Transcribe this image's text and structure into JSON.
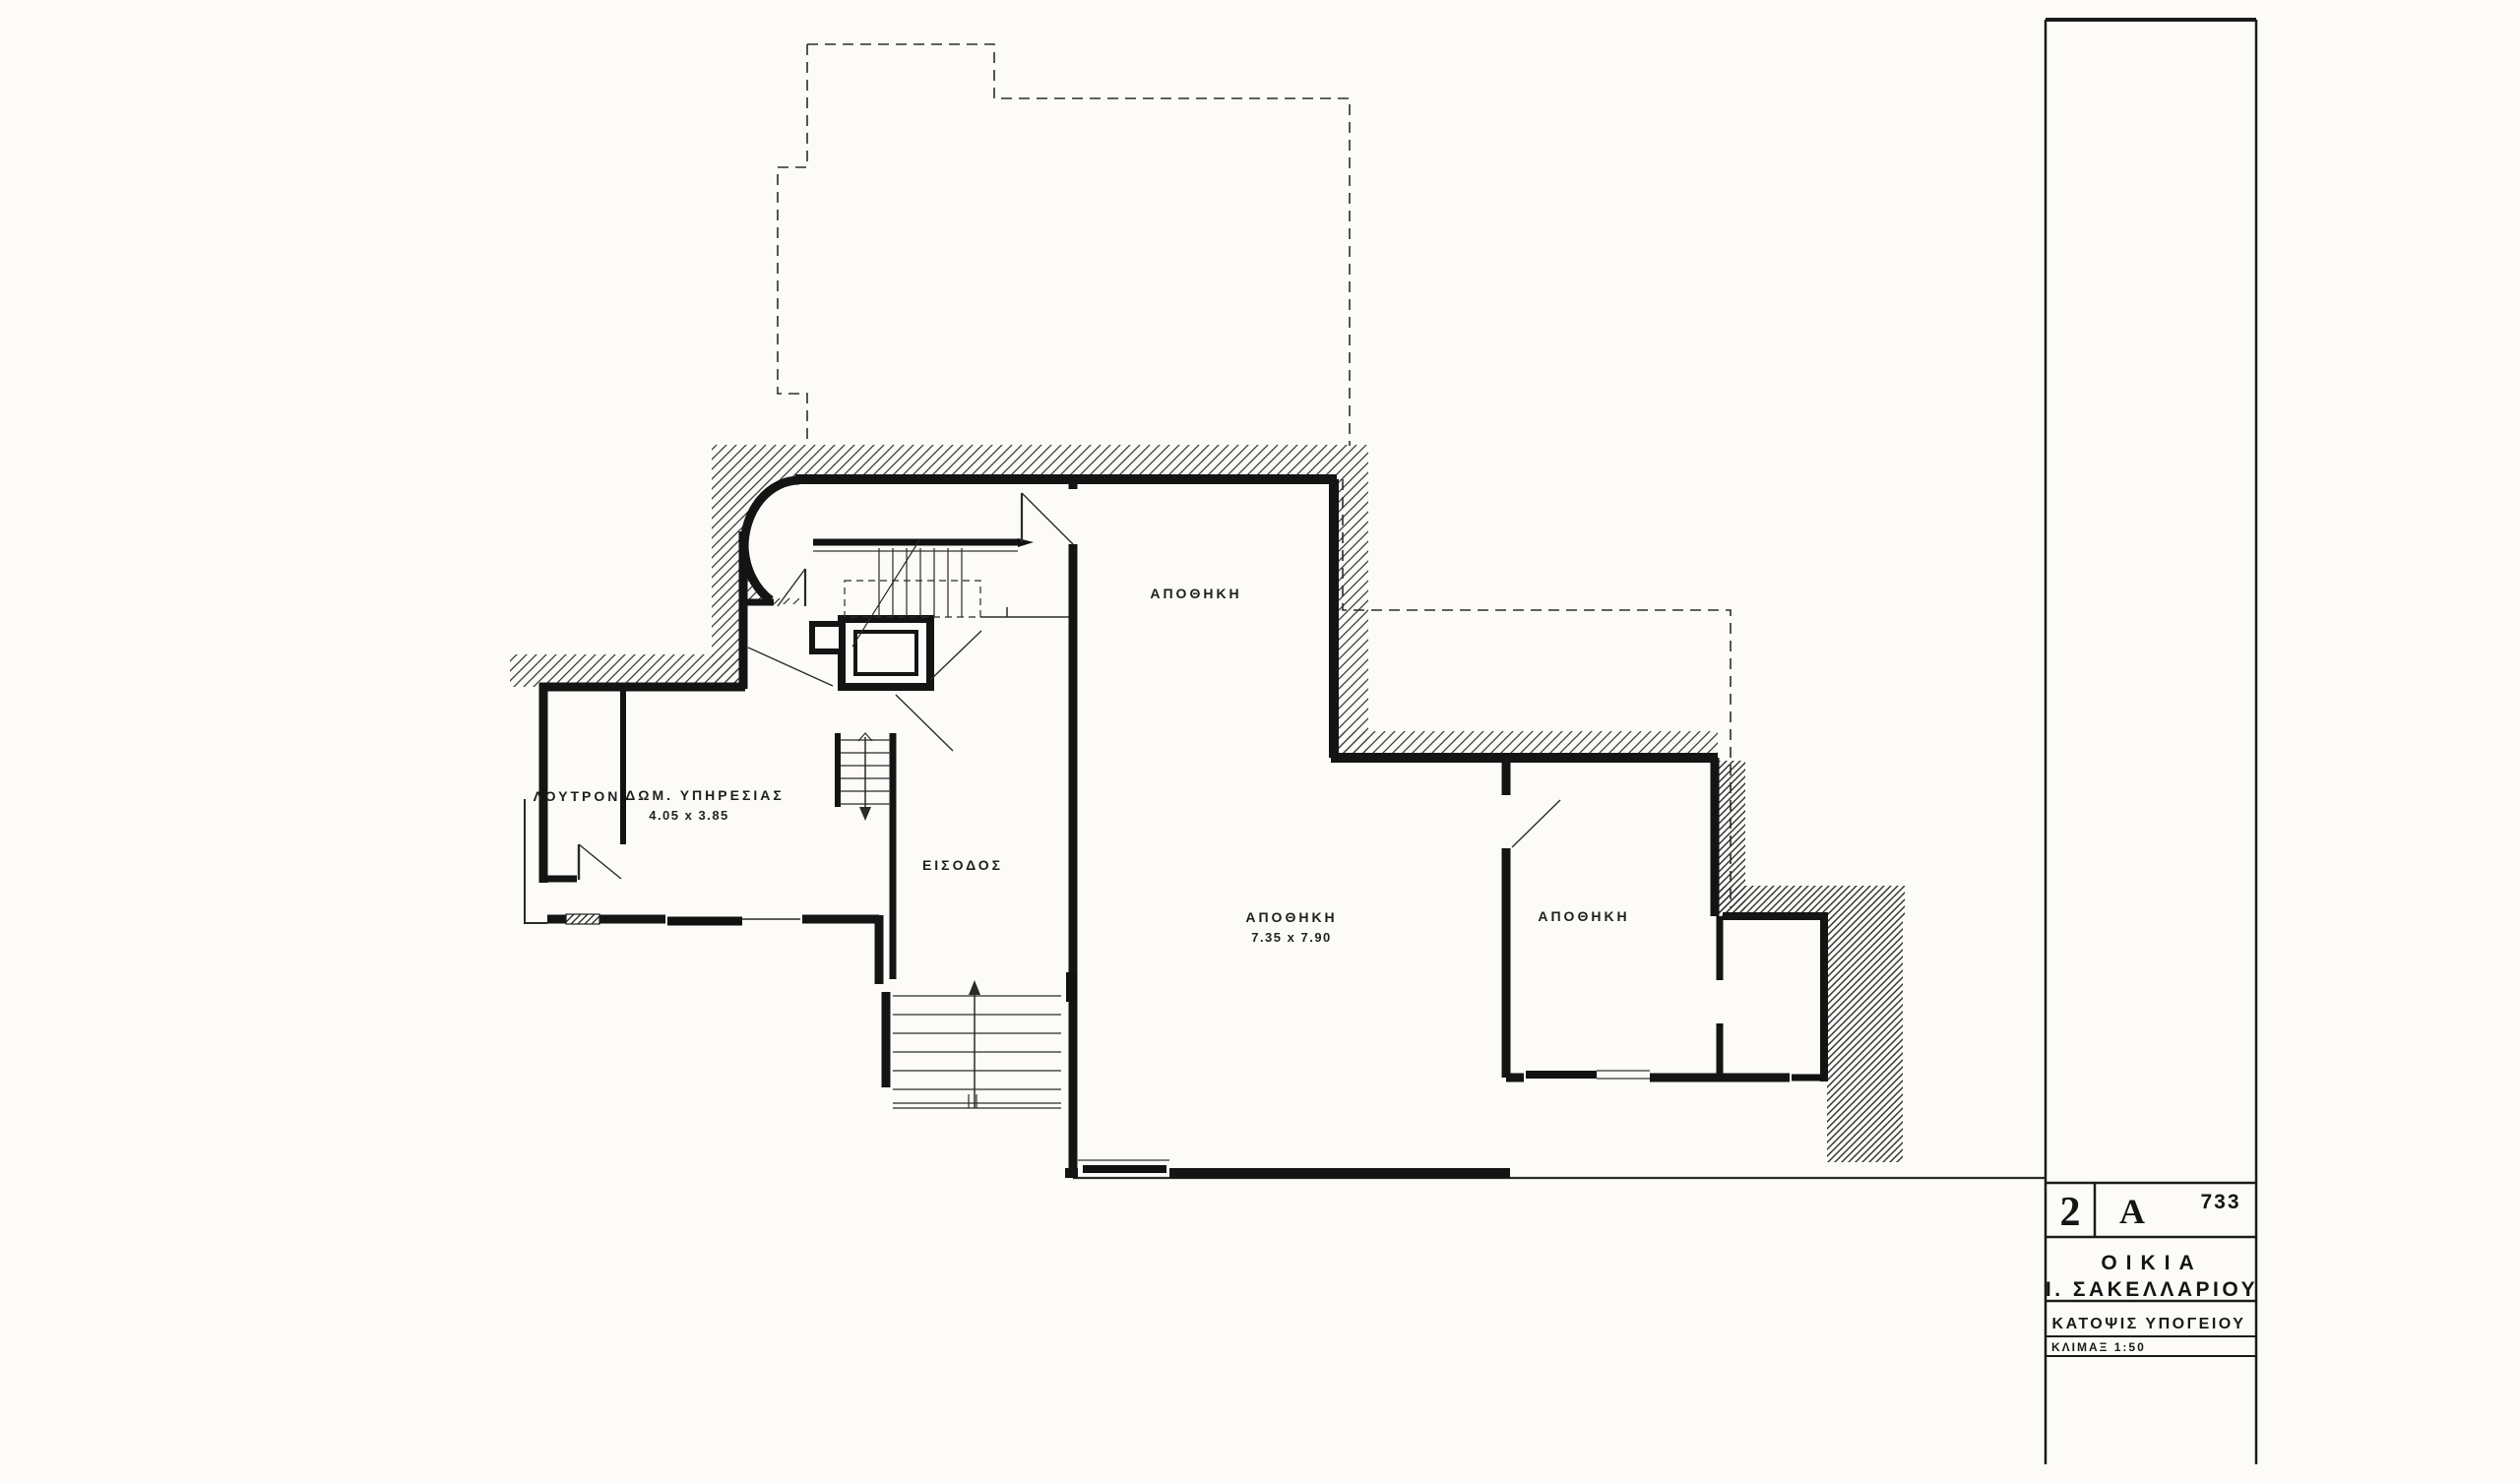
{
  "colors": {
    "paper": "#fcfbf7",
    "ink": "#1a1a1a"
  },
  "plan": {
    "room_labels": [
      {
        "id": "loutron",
        "text": "ΛΟΥΤΡΟΝ"
      },
      {
        "id": "service-room",
        "text": "ΔΩΜ. ΥΠΗΡΕΣΙΑΣ",
        "dimensions": "4.05 x 3.85"
      },
      {
        "id": "entrance",
        "text": "ΕΙΣΟΔΟΣ"
      },
      {
        "id": "storage-upper",
        "text": "ΑΠΟΘΗΚΗ"
      },
      {
        "id": "storage-main",
        "text": "ΑΠΟΘΗΚΗ",
        "dimensions": "7.35 x 7.90"
      },
      {
        "id": "storage-right",
        "text": "ΑΠΟΘΗΚΗ"
      }
    ]
  },
  "title_block": {
    "code_left": "2",
    "code_middle": "A",
    "sheet_number": "733",
    "project_line1": "ΟΙΚΙΑ",
    "project_line2": "Ι. ΣΑΚΕΛΛΑΡΙΟΥ",
    "drawing_title": "ΚΑΤΟΨΙΣ ΥΠΟΓΕΙΟΥ",
    "scale": "ΚΛΙΜΑΞ  1:50"
  }
}
